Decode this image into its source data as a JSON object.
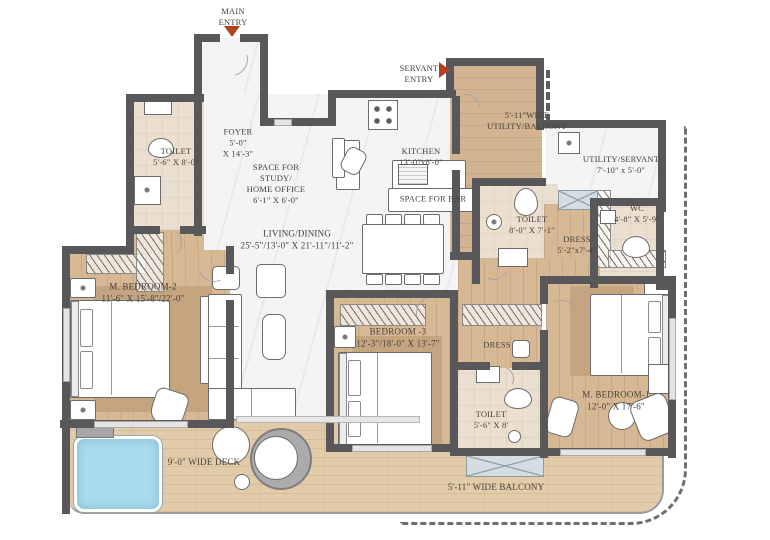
{
  "colors": {
    "wall": "#58585a",
    "wood_floor": "#d7b894",
    "deck_wood": "#e2cba9",
    "marble": "#f4f4f5",
    "toilet_beige": "#ebdfd0",
    "pool_blue": "#a9dcec",
    "entry_arrow_red": "#b5401f"
  },
  "entries": {
    "main": "MAIN\nENTRY",
    "servant": "SERVANT\nENTRY"
  },
  "rooms": {
    "foyer": {
      "name": "FOYER",
      "dims": "5'-0\"\nX 14'-3\""
    },
    "toilet_tl": {
      "name": "TOILET",
      "dims": "5'-6\" X 8'-0\""
    },
    "study": {
      "name": "SPACE FOR\nSTUDY/\nHOME OFFICE",
      "dims": "6'-1\" X 6'-0\""
    },
    "kitchen": {
      "name": "KITCHEN",
      "dims": "13'-0\"x8'-0\""
    },
    "bar": {
      "name": "SPACE FOR BAR"
    },
    "utility_balcony": {
      "name": "5'-11\"WIDE\nUTILITY/BALCONY"
    },
    "utility_servant": {
      "name": "UTILITY/SERVANT",
      "dims": "7'-10\" x 5'-0\""
    },
    "toilet_mid": {
      "name": "TOILET",
      "dims": "8'-0\" X 7'-1\""
    },
    "wc": {
      "name": "WC",
      "dims": "4'-8\" X 5'-9\""
    },
    "dress_m1": {
      "name": "DRESS",
      "dims": "5'-2\"x7'-4\""
    },
    "living": {
      "name": "LIVING/DINING",
      "dims": "25'-5\"/13'-0\" X 21'-11\"/11'-2\""
    },
    "mbr2": {
      "name": "M. BEDROOM-2",
      "dims": "11'-6\" X 15'-8\"/22'-0\""
    },
    "bedroom3": {
      "name": "BEDROOM -3",
      "dims": "12'-3\"/18'-0\" X 13'-7\""
    },
    "dress_b3": {
      "name": "DRESS"
    },
    "toilet_b3": {
      "name": "TOILET",
      "dims": "5'-6\" X 8'"
    },
    "mbr1": {
      "name": "M. BEDROOM-1",
      "dims": "12'-0\" X 17'-6\""
    },
    "deck": {
      "name": "9'-0\" WIDE DECK"
    },
    "balcony": {
      "name": "5'-11\" WIDE BALCONY"
    }
  }
}
